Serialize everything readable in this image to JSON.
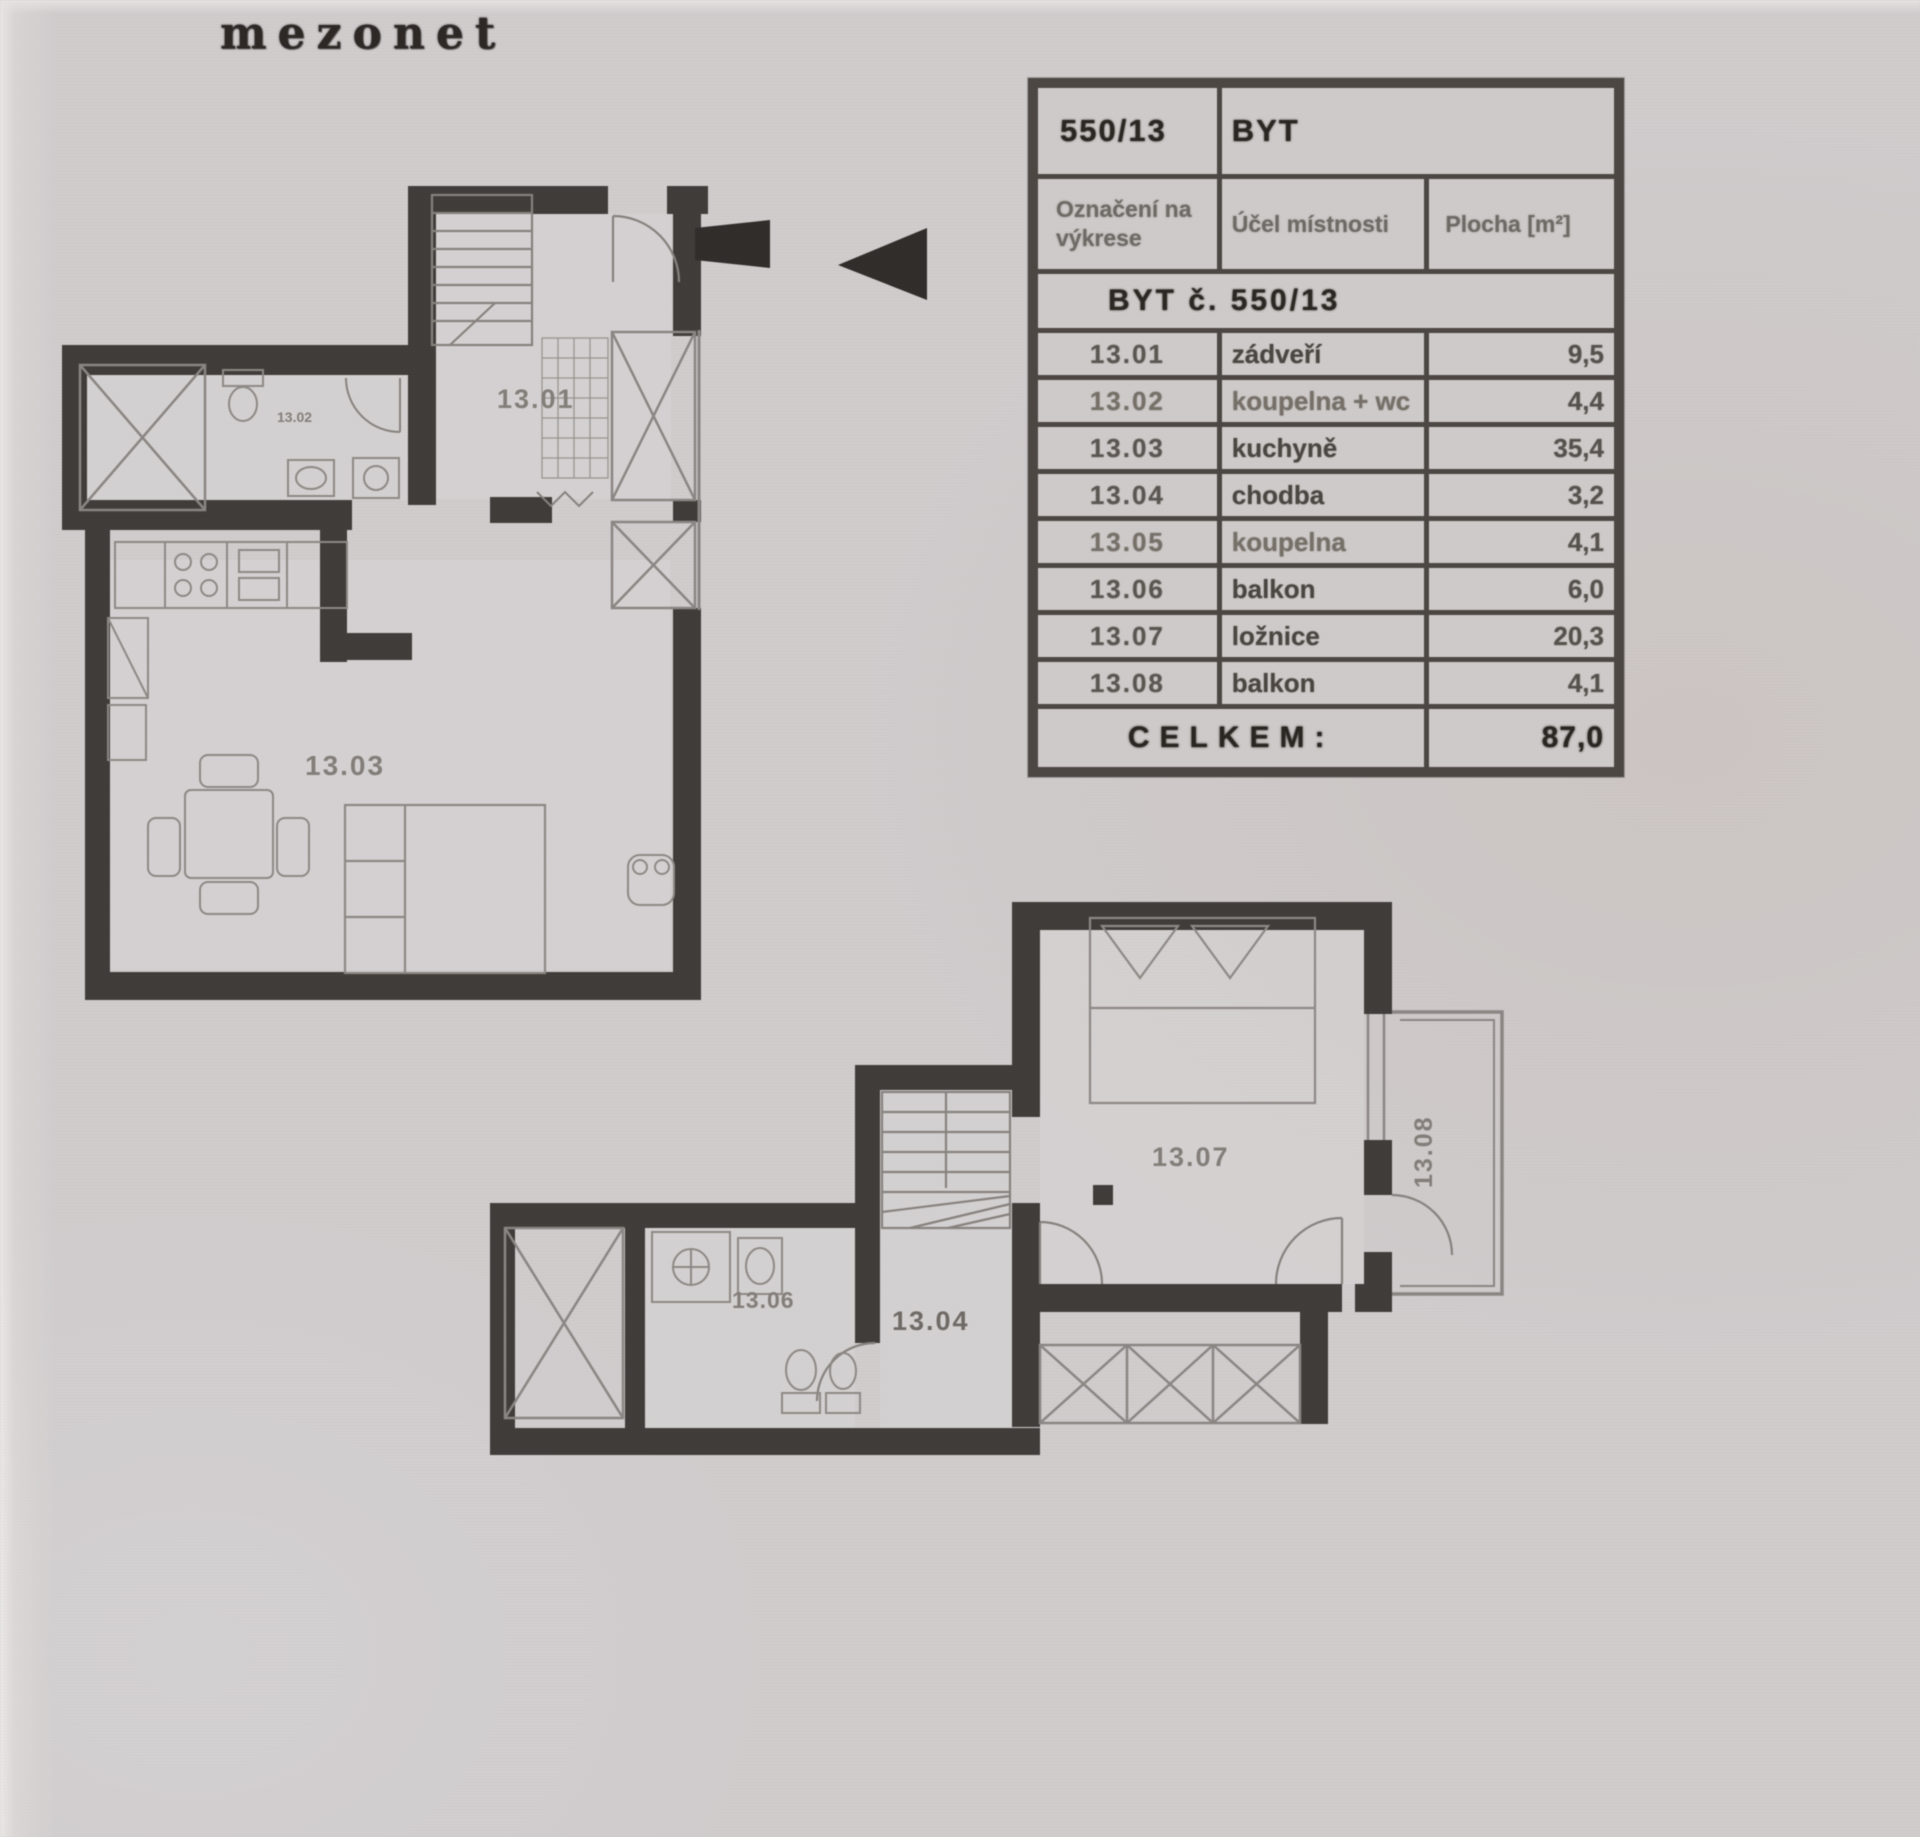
{
  "title": "mezonet",
  "table": {
    "unit_number": "550/13",
    "unit_type": "BYT",
    "col_headers": [
      "Označení na výkrese",
      "Účel místnosti",
      "Plocha [m²]"
    ],
    "section_header": "BYT č. 550/13",
    "rows": [
      {
        "code": "13.01",
        "name": "zádveří",
        "area": "9,5"
      },
      {
        "code": "13.02",
        "name": "koupelna + wc",
        "area": "4,4"
      },
      {
        "code": "13.03",
        "name": "kuchyně",
        "area": "35,4"
      },
      {
        "code": "13.04",
        "name": "chodba",
        "area": "3,2"
      },
      {
        "code": "13.05",
        "name": "koupelna",
        "area": "4,1"
      },
      {
        "code": "13.06",
        "name": "balkon",
        "area": "6,0"
      },
      {
        "code": "13.07",
        "name": "ložnice",
        "area": "20,3"
      },
      {
        "code": "13.08",
        "name": "balkon",
        "area": "4,1"
      }
    ],
    "total_label": "CELKEM:",
    "total_area": "87,0"
  },
  "plans": {
    "lower": {
      "entry": "13.01",
      "bath": "13.02",
      "living": "13.03"
    },
    "upper": {
      "hall": "13.04",
      "bath": "13.06",
      "bedroom": "13.07",
      "balcony": "13.08"
    }
  },
  "colors": {
    "wall": "#3e3a37",
    "thin_line": "#8b8683",
    "label": "#837e79",
    "ink": "#27231f",
    "paper": "#d2cecf"
  }
}
